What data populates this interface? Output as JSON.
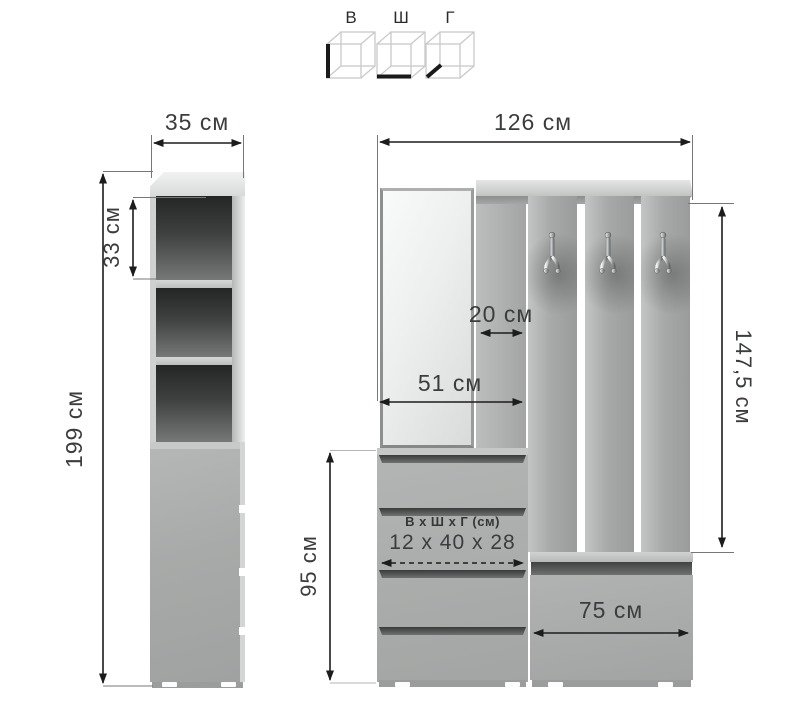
{
  "diagram": {
    "legend": {
      "items": [
        {
          "label": "В",
          "meaning": "height-cube"
        },
        {
          "label": "Ш",
          "meaning": "width-cube"
        },
        {
          "label": "Г",
          "meaning": "depth-cube"
        }
      ]
    },
    "left_cabinet": {
      "width": "35 см",
      "height": "199 см",
      "shelf_height": "33 см"
    },
    "right_unit": {
      "total_width": "126 см",
      "side_depth": "20 см",
      "mirror_width": "51 см",
      "hook_section_height": "147,5 см",
      "drawer_section_height": "95 см",
      "bench_width": "75 см",
      "drawer_dims_title": "В х Ш х Г (см)",
      "drawer_dims_value": "12 x 40 x 28"
    },
    "colors": {
      "furniture_gray": "#a8aaa9",
      "interior_dark": "#2e302f",
      "mirror_light": "#eef0f0",
      "dimension_line": "#1c1c1c",
      "text": "#3b3d3c"
    }
  }
}
